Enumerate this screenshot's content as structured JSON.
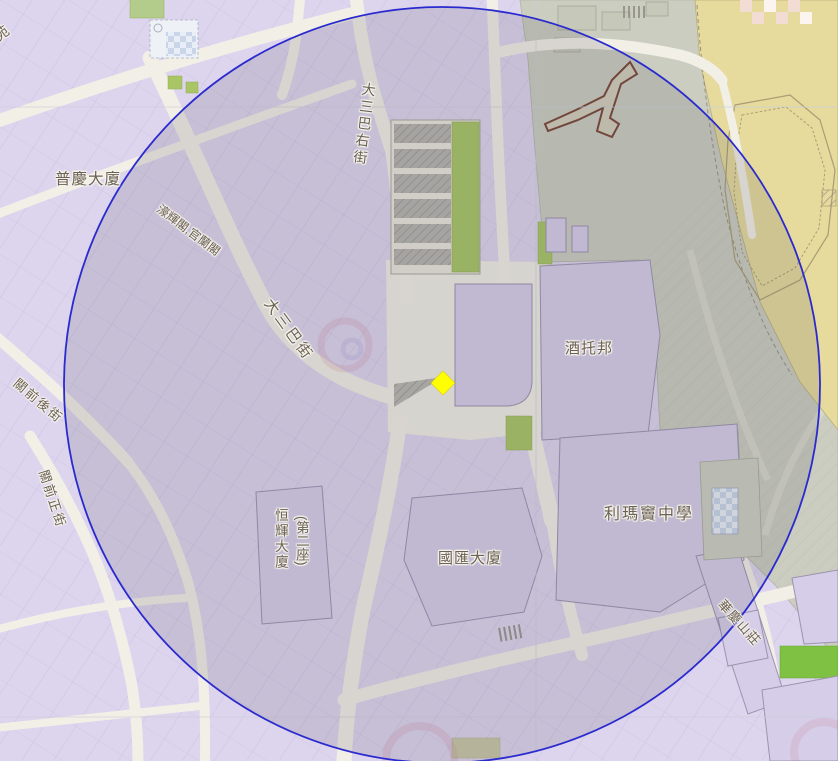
{
  "map": {
    "labels": {
      "yuan": {
        "text": "苑"
      },
      "puqing": {
        "text": "普慶大廈"
      },
      "haofai": {
        "text": "濠輝閣,官蘭閣"
      },
      "dsb_right": {
        "text": "大三巴右街"
      },
      "dsb": {
        "text": "大三巴街"
      },
      "guanqian_back": {
        "text": "關前後街"
      },
      "guanqian_main": {
        "text": "關前正街"
      },
      "hengfai_1": {
        "text": "恒輝大廈"
      },
      "hengfai_2": {
        "text": "(第二座)"
      },
      "guohui": {
        "text": "國匯大廈"
      },
      "ricci": {
        "text": "利瑪竇中學"
      },
      "jiutuobang": {
        "text": "酒托邦"
      },
      "huaqing": {
        "text": "華慶山莊"
      }
    },
    "marker": {
      "shape": "diamond",
      "color": "#ffff00"
    },
    "radius_circle": {
      "cx": 442,
      "cy": 385,
      "r": 378,
      "stroke": "#2a2ace",
      "fill": "rgba(80,80,95,0.16)"
    },
    "colors": {
      "building": "#ddd4ee",
      "building_named": "#d6cde8",
      "road": "#f2efe7",
      "green": "#a9c566",
      "fort_tan": "#e6da9d",
      "hillside": "#cbcdc0",
      "label_text": "#6b6156",
      "wall_ruin": "#7a4436"
    }
  }
}
